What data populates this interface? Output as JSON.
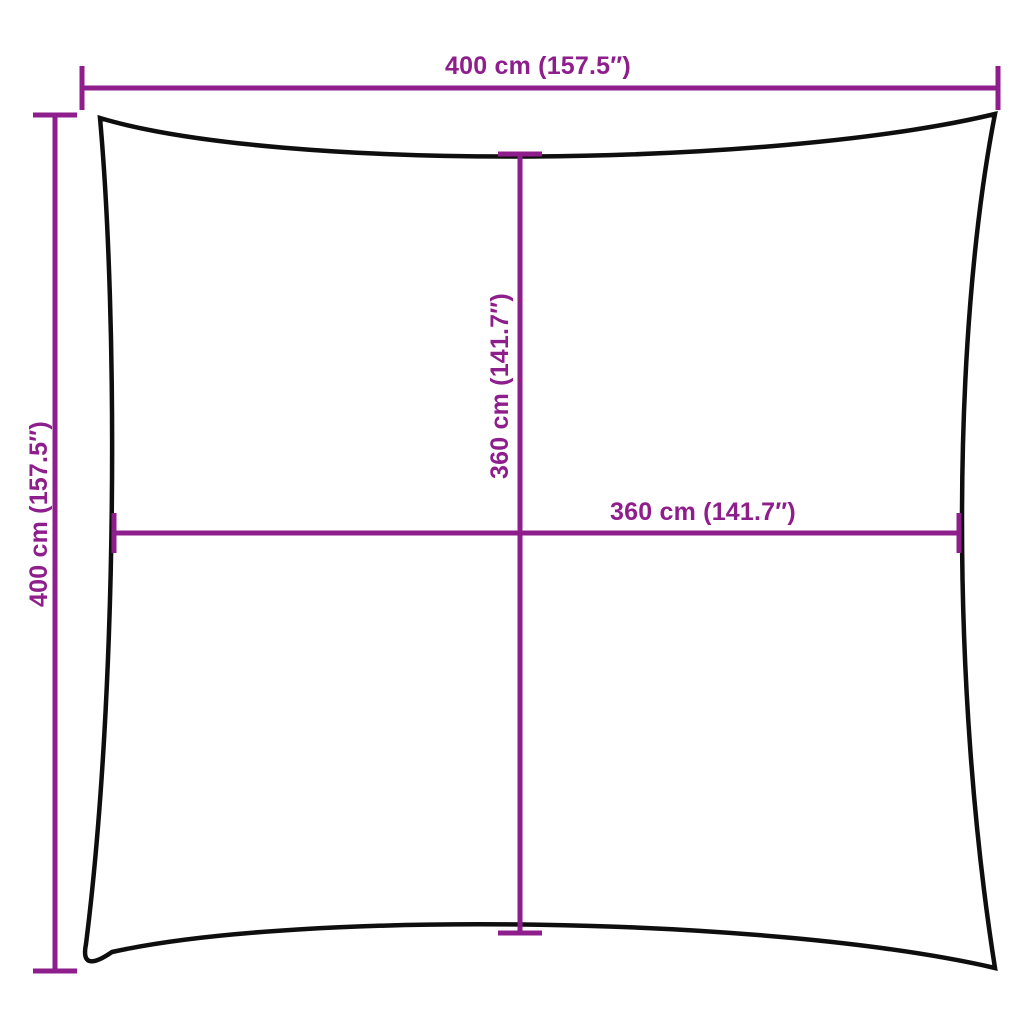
{
  "diagram": {
    "colors": {
      "background": "#ffffff",
      "dimension": "#8e1e8c",
      "outline": "#0e0e0e"
    },
    "dimensions": {
      "top": {
        "label": "400 cm (157.5″)",
        "value_cm": 400,
        "value_in": 157.5
      },
      "left": {
        "label": "400 cm (157.5″)",
        "value_cm": 400,
        "value_in": 157.5
      },
      "middle_vertical": {
        "label": "360 cm (141.7″)",
        "value_cm": 360,
        "value_in": 141.7
      },
      "middle_horizontal": {
        "label": "360 cm (141.7″)",
        "value_cm": 360,
        "value_in": 141.7
      }
    }
  }
}
